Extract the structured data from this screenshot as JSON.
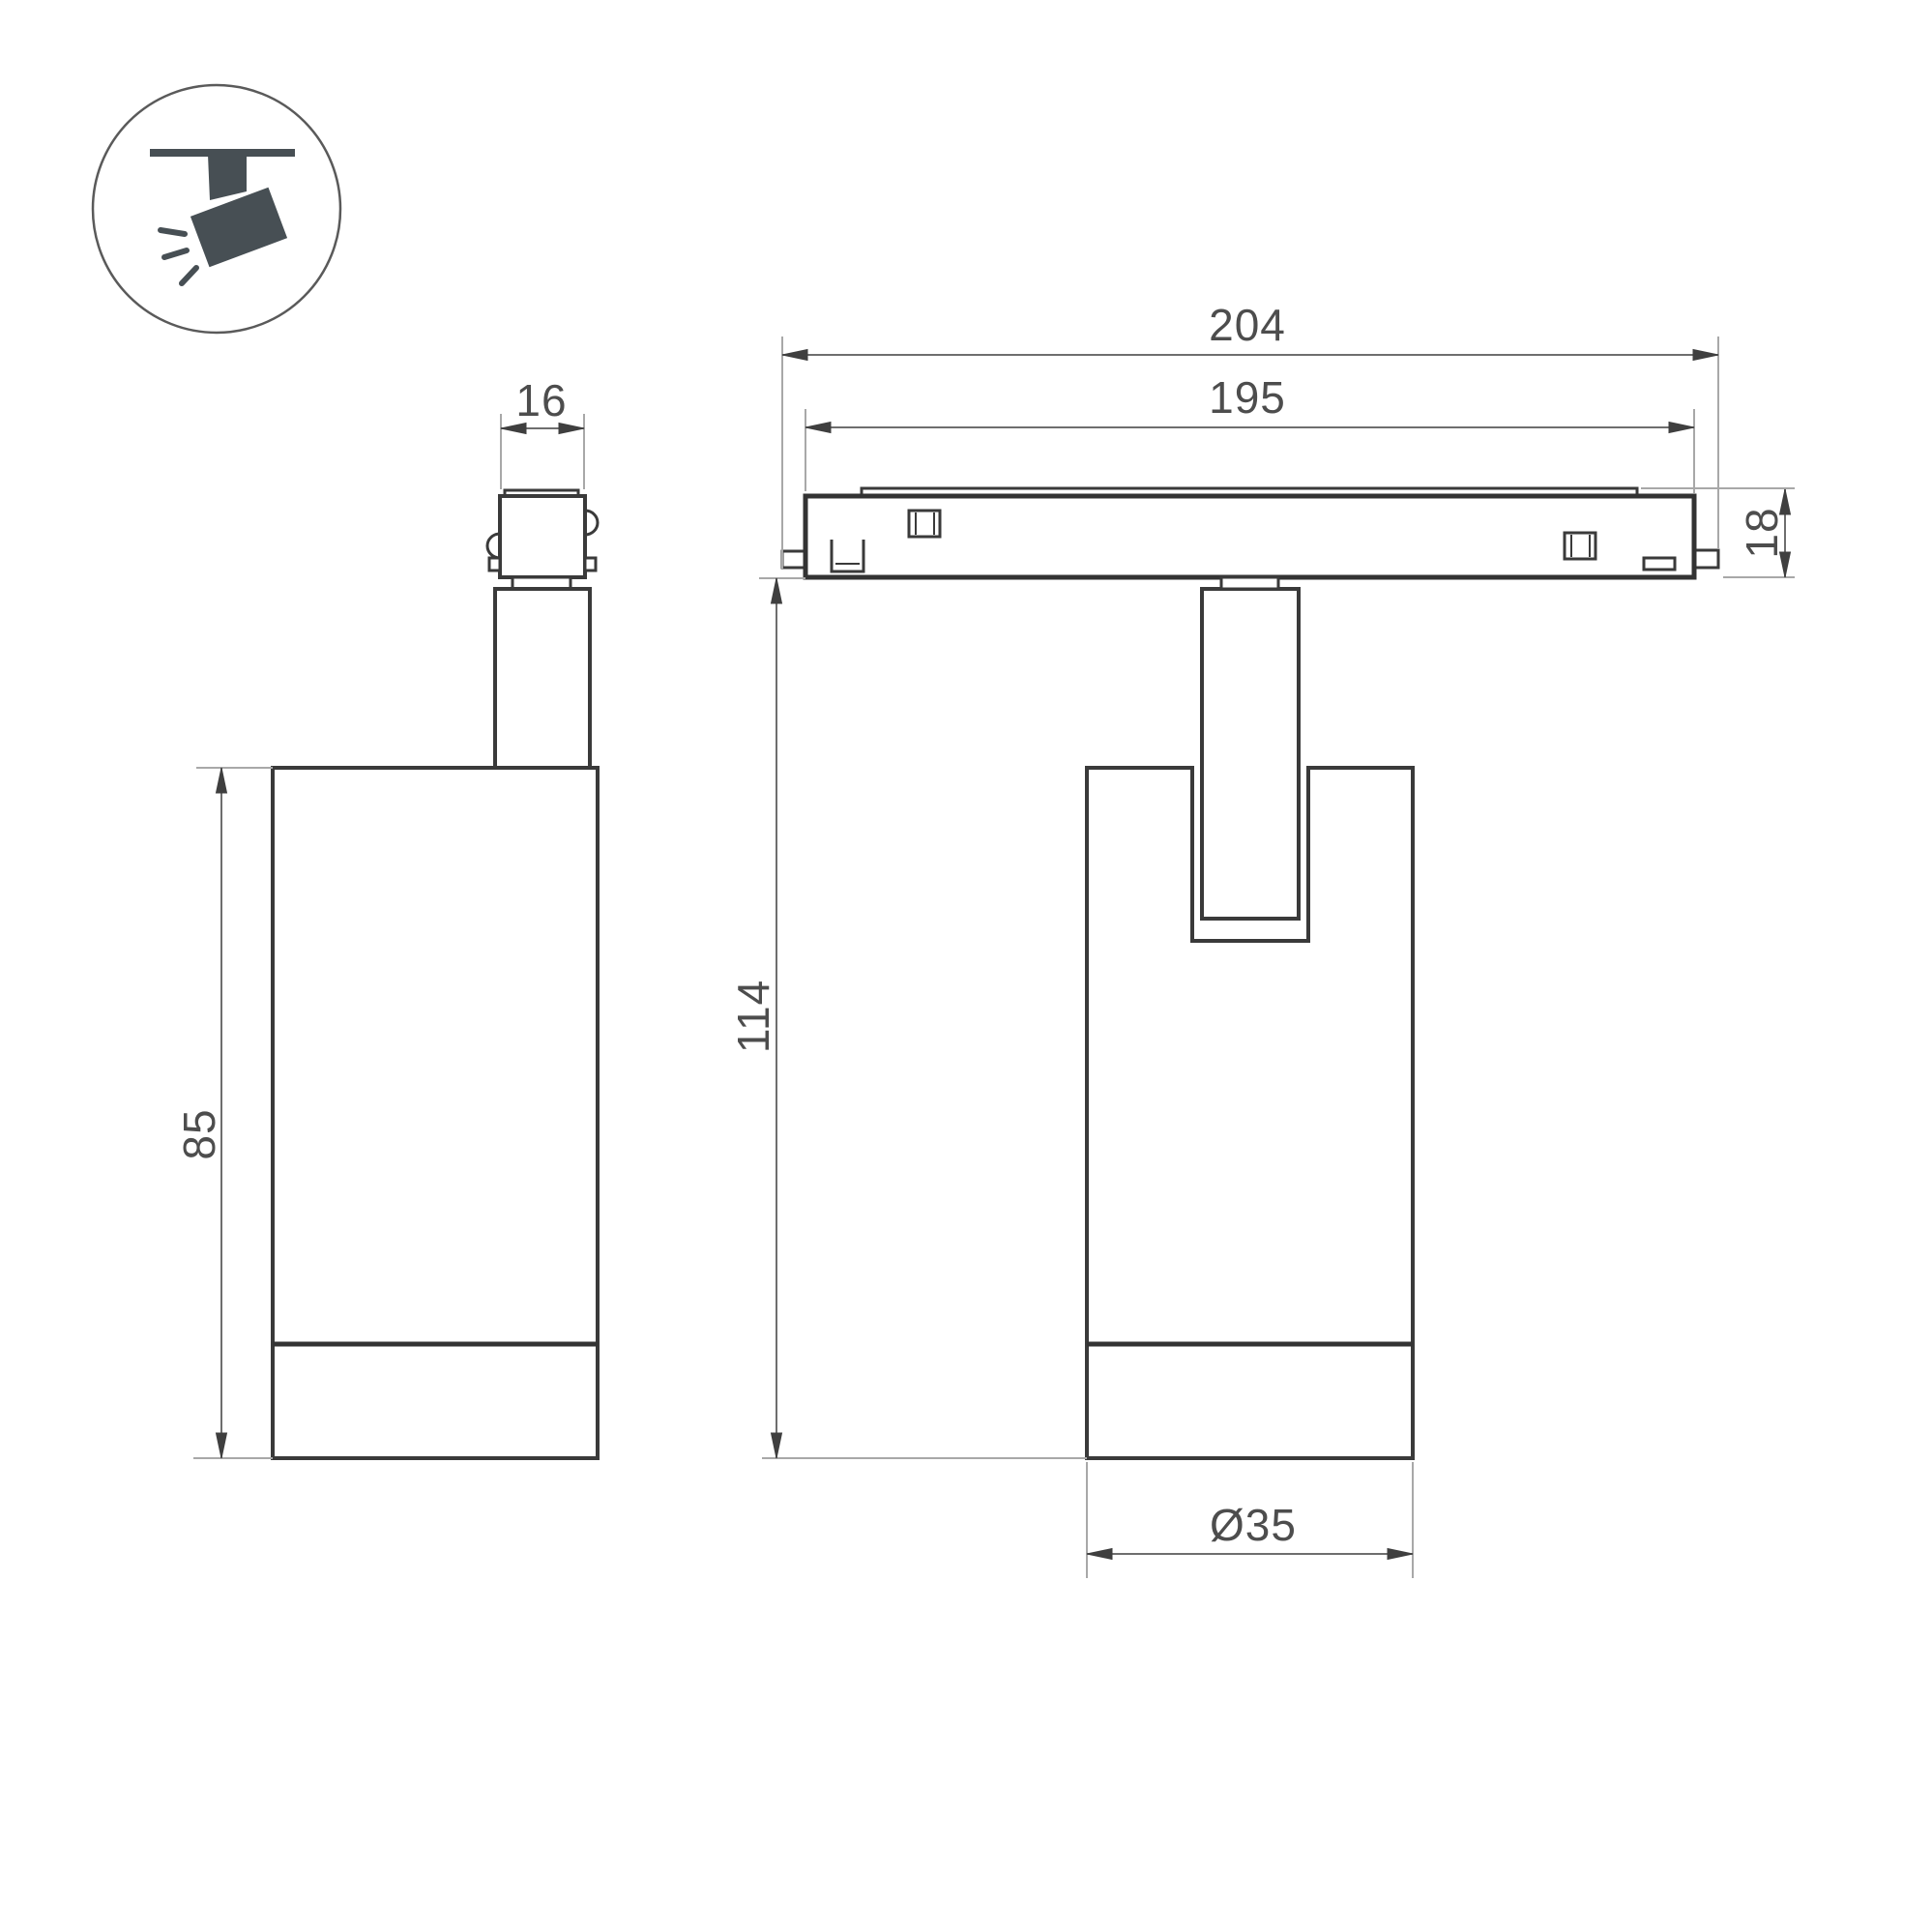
{
  "title": "Track spotlight luminaire dimension drawing",
  "icon": {
    "label": "ceiling-track-spotlight-pictogram"
  },
  "dimensions": {
    "adapter_width": "16",
    "body_height": "85",
    "track_length_outer": "204",
    "track_length_inner": "195",
    "track_height": "18",
    "overall_height": "114",
    "body_diameter": "Ø35"
  },
  "colors": {
    "outline": "#3a3a3a",
    "dimension_line": "#6e6e6e",
    "extension_line": "#a8a8a8",
    "dimension_text": "#4d4d4d",
    "icon_fill": "#474f54",
    "background": "#ffffff"
  }
}
